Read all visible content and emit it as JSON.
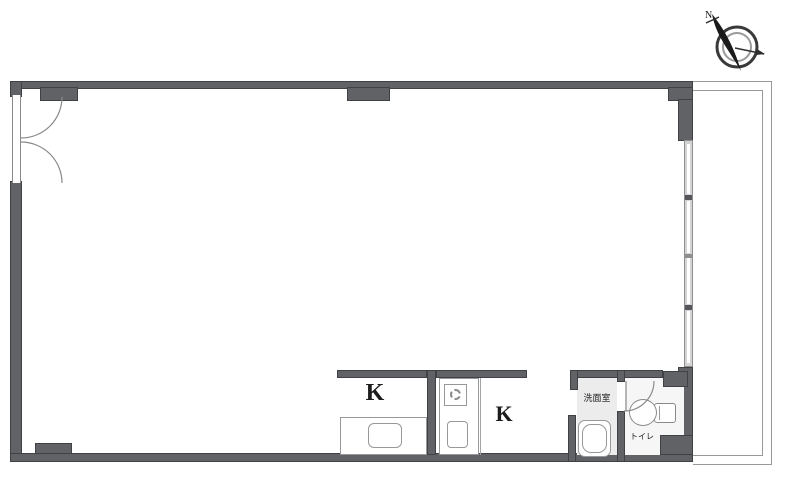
{
  "plan": {
    "type": "floor-plan",
    "orientation_note": "compass needle points upper-left"
  },
  "compass": {
    "north_label": "N"
  },
  "rooms": {
    "kitchen": {
      "label_left": "K",
      "label_right": "K"
    },
    "washroom": {
      "label": "洗面室"
    },
    "toilet": {
      "label": "トイレ"
    }
  },
  "colors": {
    "wall": "#616266",
    "wall_dark": "#404144",
    "outline": "#96989a",
    "floor_light": "#ececec",
    "floor_toilet": "#f6f6f6",
    "window_bg": "#d3d3d3",
    "background": "#ffffff",
    "text": "#1c1c1c"
  }
}
